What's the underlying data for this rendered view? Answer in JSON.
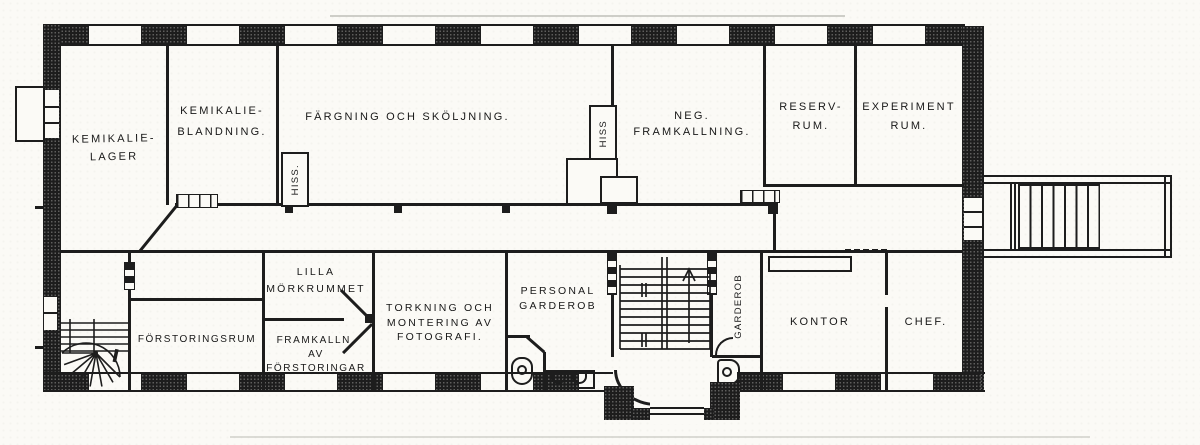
{
  "drawing": {
    "type": "architectural-floor-plan"
  },
  "rooms": {
    "kemikalie_lager": {
      "lines": [
        "KEMIKALIE-",
        "LAGER"
      ]
    },
    "kemikalie_blandning": {
      "lines": [
        "KEMIKALIE-",
        "BLANDNING."
      ]
    },
    "fargning": {
      "lines": [
        "FÄRGNING OCH SKÖLJNING."
      ]
    },
    "neg_framkallning": {
      "lines": [
        "NEG.",
        "FRAMKALLNING."
      ]
    },
    "reservrum": {
      "lines": [
        "RESERV-",
        "RUM."
      ]
    },
    "experimentrum": {
      "lines": [
        "EXPERIMENT",
        "RUM."
      ]
    },
    "forstoringsrum": {
      "lines": [
        "FÖRSTORINGSRUM"
      ]
    },
    "lilla_morkrummet": {
      "lines": [
        "LILLA",
        "MÖRKRUMMET"
      ]
    },
    "framkallning_av_forstoringar": {
      "lines": [
        "FRAMKALLN.",
        "AV",
        "FÖRSTORINGAR"
      ]
    },
    "torkning": {
      "lines": [
        "TORKNING OCH",
        "MONTERING AV",
        "FOTOGRAFI."
      ]
    },
    "personal_garderob": {
      "lines": [
        "PERSONAL",
        "GARDEROB"
      ]
    },
    "garderob": {
      "lines": [
        "GARDEROB"
      ]
    },
    "kontor": {
      "lines": [
        "KONTOR"
      ]
    },
    "chef": {
      "lines": [
        "CHEF."
      ]
    },
    "hiss_1": {
      "lines": [
        "HISS."
      ]
    },
    "hiss_2": {
      "lines": [
        "HISS"
      ]
    }
  },
  "colors": {
    "ink": "#1d1d1d",
    "paper": "#fbfaf6"
  }
}
